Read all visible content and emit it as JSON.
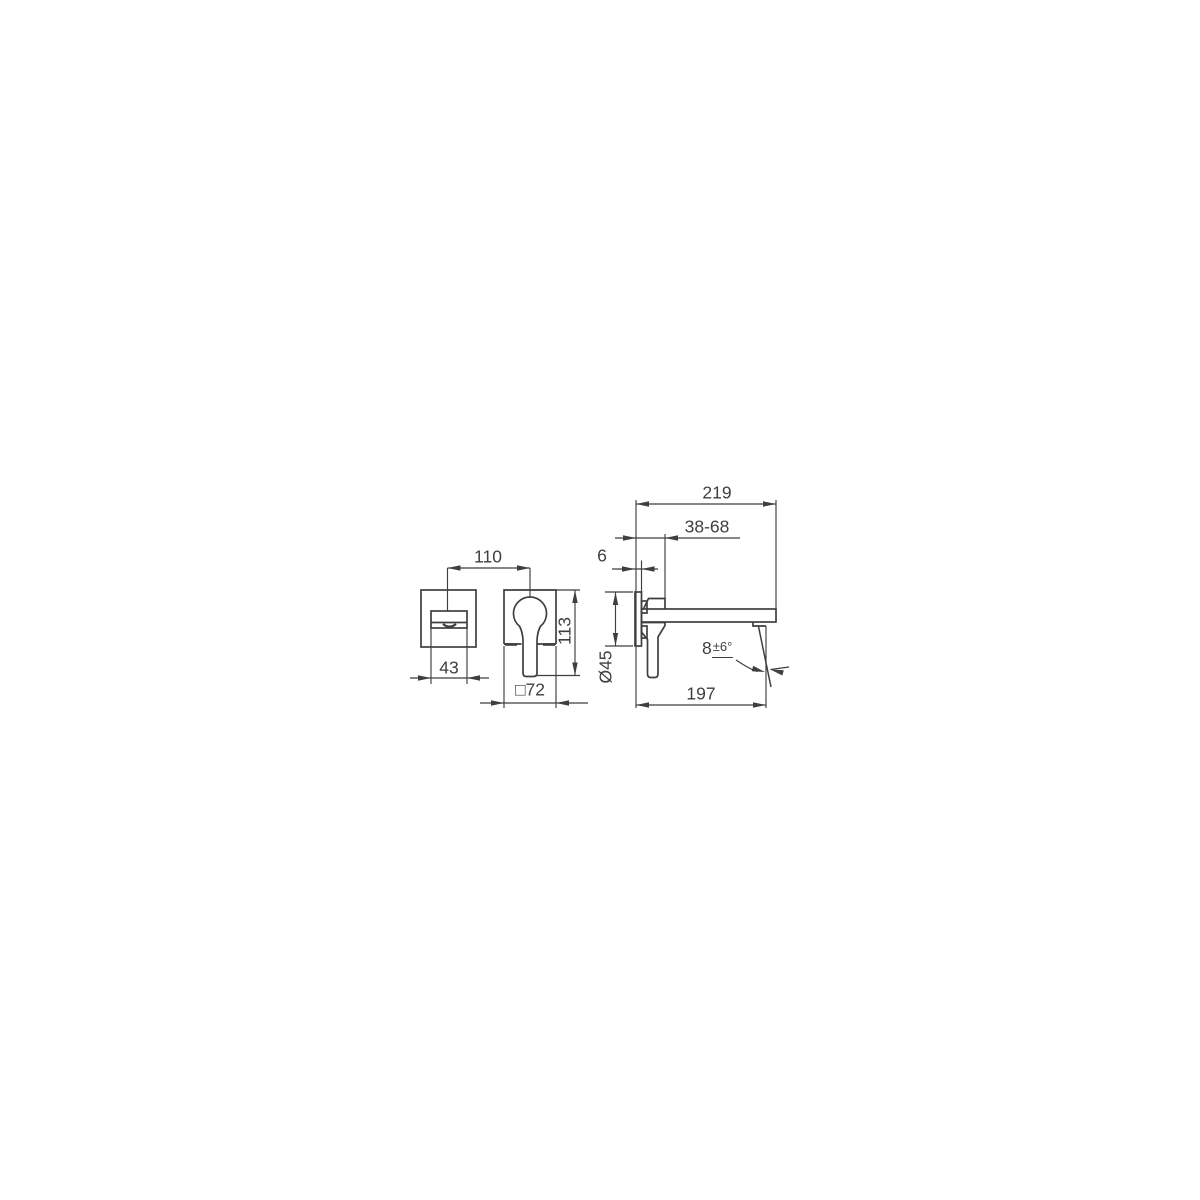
{
  "canvas": {
    "background": "#ffffff",
    "line_color": "#3f3f3f",
    "text_color": "#3f3f3f"
  },
  "labels": {
    "spacing": "110",
    "spout_width": "43",
    "handle_height": "113",
    "plate_size": "□72",
    "total_projection": "219",
    "mounting_depth_range": "38-68",
    "plate_thickness": "6",
    "connection_diameter": "Ø45",
    "spout_projection": "197",
    "angle_base": "8",
    "angle_tolerance": "±6°"
  }
}
